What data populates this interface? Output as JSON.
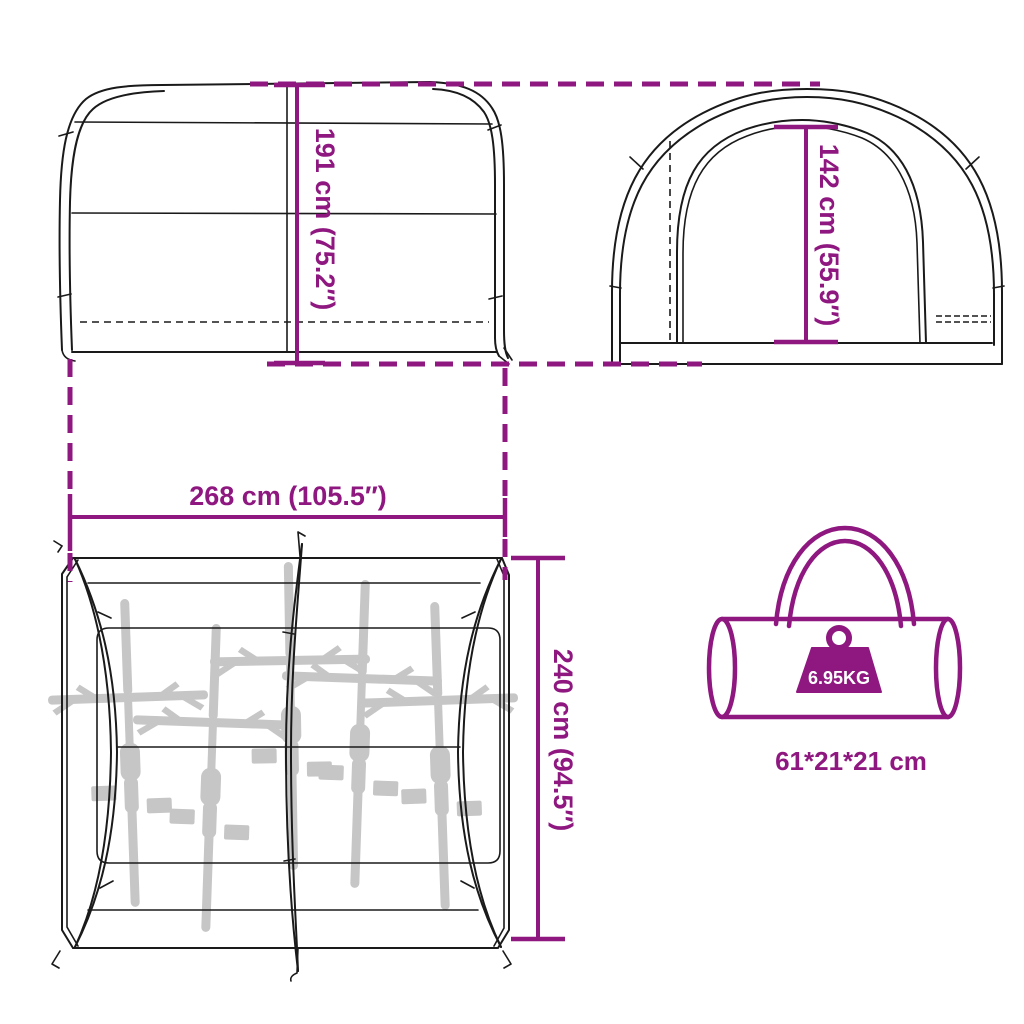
{
  "colors": {
    "accent": "#8E1780",
    "line": "#1A1A1A",
    "bike_silhouette": "#C6C6C6",
    "weight_label_text": "#FFFFFF",
    "background": "#FFFFFF"
  },
  "dimensions": {
    "side_height": "191 cm (75.2″)",
    "door_height": "142 cm (55.9″)",
    "width": "268 cm (105.5″)",
    "depth": "240 cm (94.5″)"
  },
  "bag": {
    "weight": "6.95KG",
    "size": "61*21*21 cm"
  },
  "top_view": {
    "bikes_shown": 5
  }
}
